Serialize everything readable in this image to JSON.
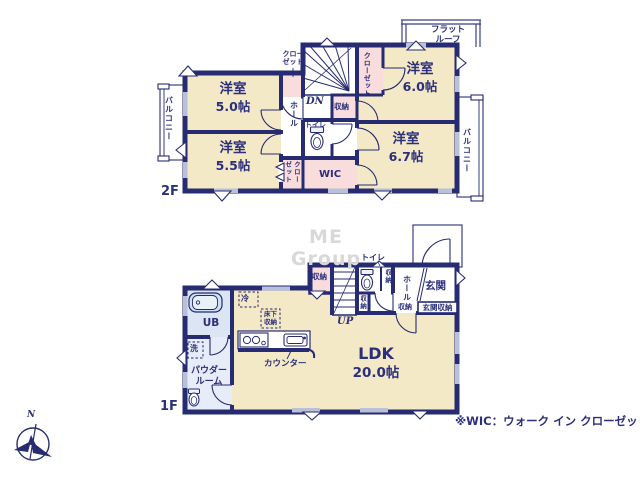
{
  "watermark": "ME Group",
  "footnote": "※WIC：ウォーク イン クローゼット",
  "compass_north": "N",
  "colors": {
    "wall": "#262b72",
    "room": "#f4e9c6",
    "closet": "#f9dcdc",
    "bath": "#dbe5f3",
    "text": "#2b2f7c"
  },
  "floor2": {
    "floor_label": "2F",
    "room_nw_name": "洋室",
    "room_nw_size": "5.0帖",
    "room_ne_name": "洋室",
    "room_ne_size": "6.0帖",
    "room_sw_name": "洋室",
    "room_sw_size": "5.5帖",
    "room_se_name": "洋室",
    "room_se_size": "6.7帖",
    "balcony_left": "バルコニー",
    "balcony_right": "バルコニー",
    "flat_roof_l1": "フラット",
    "flat_roof_l2": "ルーフ",
    "closet_top_l1": "クロー",
    "closet_top_l2": "ゼット",
    "closet_ne": "クローゼット",
    "closet_sw_l1": "クロー",
    "closet_sw_l2": "ゼット",
    "hall": "ホール",
    "storage": "収納",
    "toilet": "トイレ",
    "wic": "WIC",
    "dn": "DN"
  },
  "floor1": {
    "floor_label": "1F",
    "ldk_name": "LDK",
    "ldk_size": "20.0帖",
    "unit_bath": "UB",
    "wash": "洗",
    "powder_l1": "パウダー",
    "powder_l2": "ルーム",
    "fridge": "冷",
    "underfloor_l1": "床下",
    "underfloor_l2": "収納",
    "counter": "カウンター",
    "up": "UP",
    "storage_a": "収納",
    "storage_b": "収納",
    "storage_c": "収納",
    "storage_d": "収納",
    "toilet": "トイレ",
    "hall": "ホール",
    "entrance": "玄関",
    "entrance_storage": "玄関収納"
  }
}
